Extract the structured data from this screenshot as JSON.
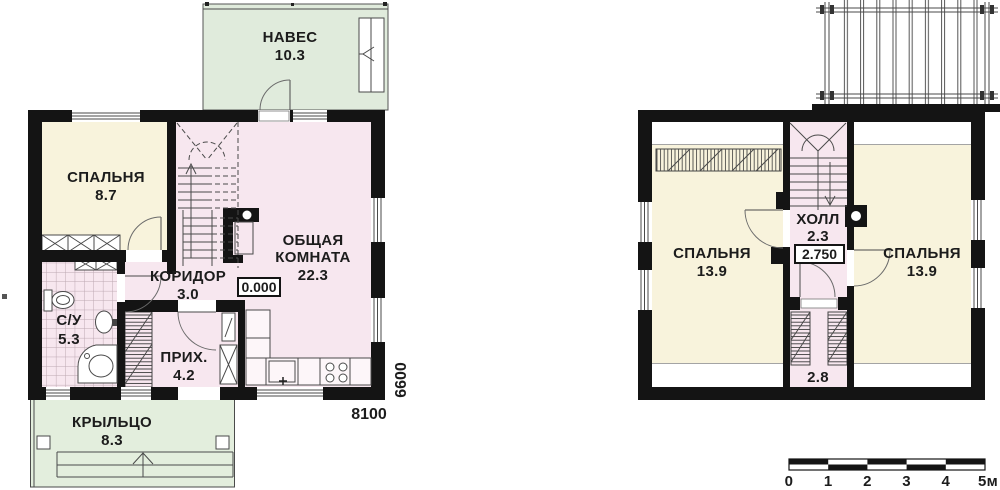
{
  "floor1": {
    "naves": {
      "name": "НАВЕС",
      "area": "10.3"
    },
    "spalnya": {
      "name": "СПАЛЬНЯ",
      "area": "8.7"
    },
    "obshchaya": {
      "line1": "ОБЩАЯ",
      "line2": "КОМНАТА",
      "area": "22.3"
    },
    "koridor": {
      "name": "КОРИДОР",
      "area": "3.0"
    },
    "su": {
      "name": "С/У",
      "area": "5.3"
    },
    "prihozhaya": {
      "name": "ПРИХ.",
      "area": "4.2"
    },
    "kryltso": {
      "name": "КРЫЛЬЦО",
      "area": "8.3"
    },
    "elevation": "0.000",
    "dim_width": "8100",
    "dim_height": "6600"
  },
  "floor2": {
    "spalnya_left": {
      "name": "СПАЛЬНЯ",
      "area": "13.9"
    },
    "spalnya_right": {
      "name": "СПАЛЬНЯ",
      "area": "13.9"
    },
    "holl": {
      "name": "ХОЛЛ",
      "area": "2.3"
    },
    "elevation": "2.750",
    "closet_area": "2.8"
  },
  "scale_bar": {
    "labels": [
      "0",
      "1",
      "2",
      "3",
      "4",
      "5м"
    ]
  },
  "colors": {
    "wall": "#141414",
    "canopy_green": "#e0ebdc",
    "porch_green": "#e3eedd",
    "cream": "#f8f3dc",
    "pink": "#f7e7ef"
  }
}
